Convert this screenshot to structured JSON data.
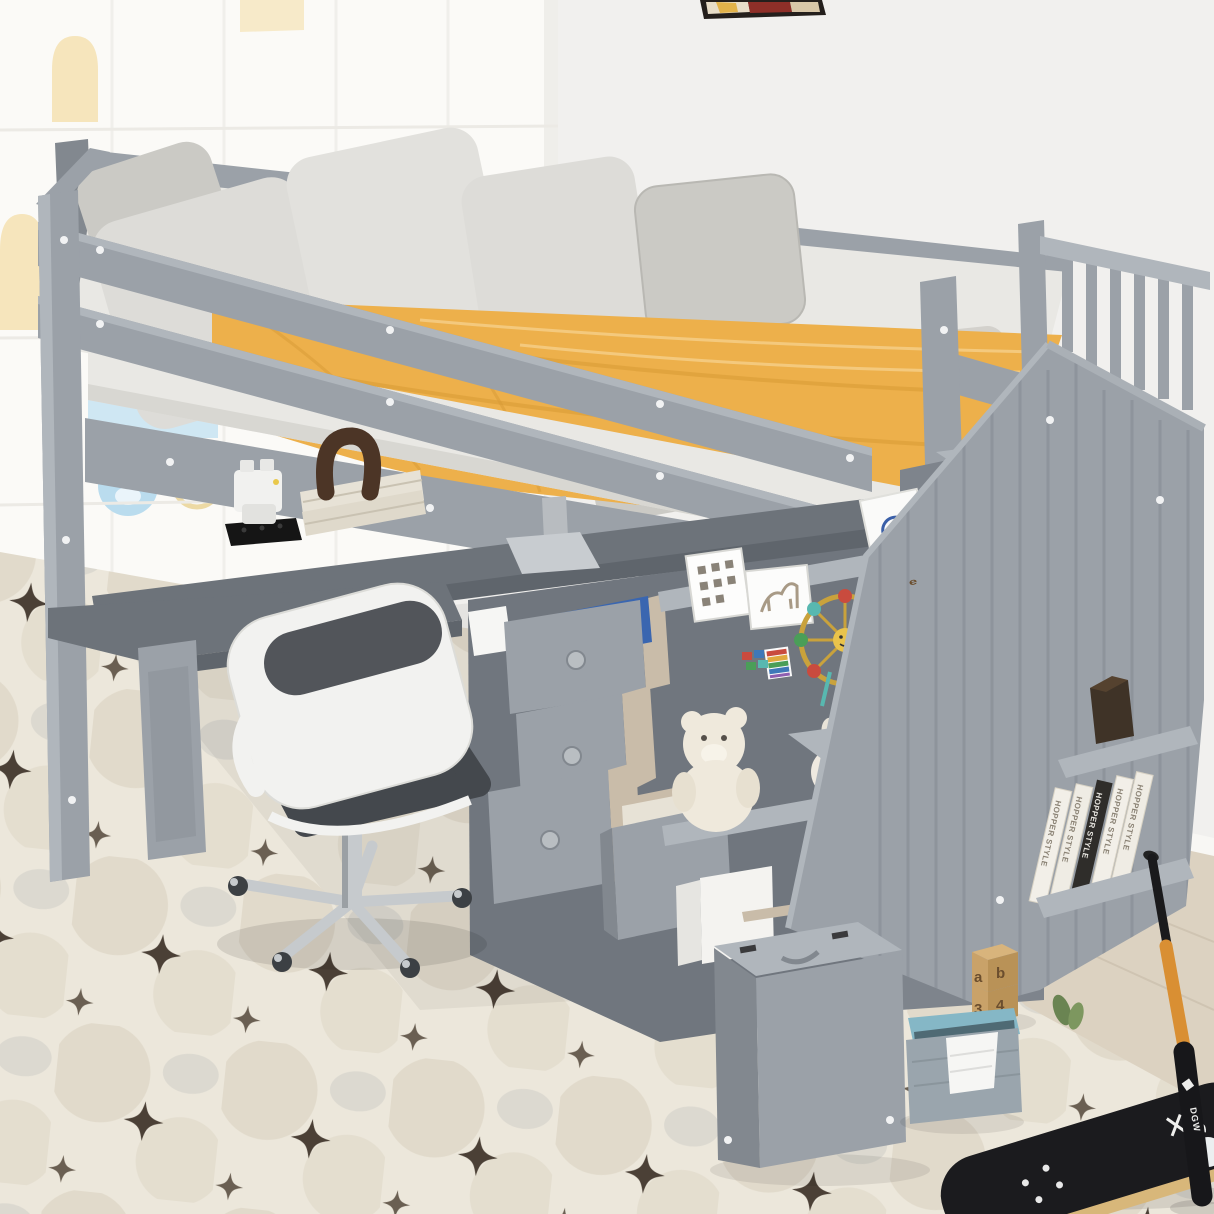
{
  "scene": {
    "type": "product photo",
    "subject": "Gray twin-size loft bed with storage staircase, shelves, drawers and L-shaped desk",
    "room": "kids bedroom with white wardrobe, white wall, wood floor and patterned area rug",
    "bed_color_name": "Gray",
    "bedding": "yellow comforter, white sheets, gray and white pillows"
  },
  "objects": [
    "loft bed frame",
    "guardrails",
    "mattress with yellow comforter",
    "seven pillows",
    "storage staircase with flip-top steps",
    "stair railing with slats",
    "L-shaped desk",
    "monitor stand",
    "office chair",
    "three staggered drawers",
    "wide bottom drawer with book",
    "cubby shelf with teddy bear and knit bunny",
    "picture frames",
    "lego ferris wheel",
    "lego brickheadz figure",
    "book stack with wooden arch bookend",
    "hopper style books",
    "hexagon ornament",
    "white wardrobe with bear handles",
    "wall artwork",
    "wall hook",
    "letter blocks",
    "fabric storage bin with cloth",
    "skateboard",
    "baseball bat",
    "area rug"
  ],
  "text": {
    "hopper": "HOPPER STYLE",
    "liquid": "LIQUID",
    "charcoal": "CHARCOAL",
    "fu": "FU",
    "bat_brand": "DGW",
    "block_e": "e",
    "block_a": "a",
    "block_b": "b",
    "block_3": "3",
    "block_4": "4"
  },
  "palette": {
    "wall": "#f1f0ee",
    "ward": "#fbfaf7",
    "cream": "#f5e2b5",
    "bluepanel": "#cfe7f3",
    "bluebear": "#badcee",
    "floor": "#dcd2c1",
    "baseb": "#f8f7f4",
    "rugbase": "#ece7db",
    "rugstar": "#3d3228",
    "frame": "#9ba1a8",
    "framelight": "#b0b6bc",
    "framedark": "#82888f",
    "framedarker": "#6e747b",
    "desk": "#5f656c",
    "desk2": "#6d737a",
    "matt": "#e9e8e4",
    "mattsh": "#d8d7d2",
    "pil": "#dddcd8",
    "pil2": "#cbcac5",
    "pil3": "#bfbeb9",
    "blanket": "#edb04b",
    "blanketd": "#d79a35",
    "blanketl": "#f5cf8a",
    "white": "#f6f6f4",
    "chairw": "#f2f2f0",
    "chairg": "#44484d",
    "chrome": "#c6cacd",
    "woodin": "#c9bca9",
    "bookc": "#e7e2d6",
    "bookd": "#2f2d2a",
    "brown": "#4c3526",
    "binb": "#85b7c6",
    "bing": "#9aa5ad",
    "binin": "#4f6a74",
    "block": "#c9a269",
    "blockf": "#d8b47c",
    "deck": "#1b1b1e",
    "rim": "#d8b77a",
    "batw": "#d98f33",
    "batb": "#17171a",
    "green": "#6a8452",
    "legob": "#3a66b0",
    "teal": "#7fb9c8"
  }
}
